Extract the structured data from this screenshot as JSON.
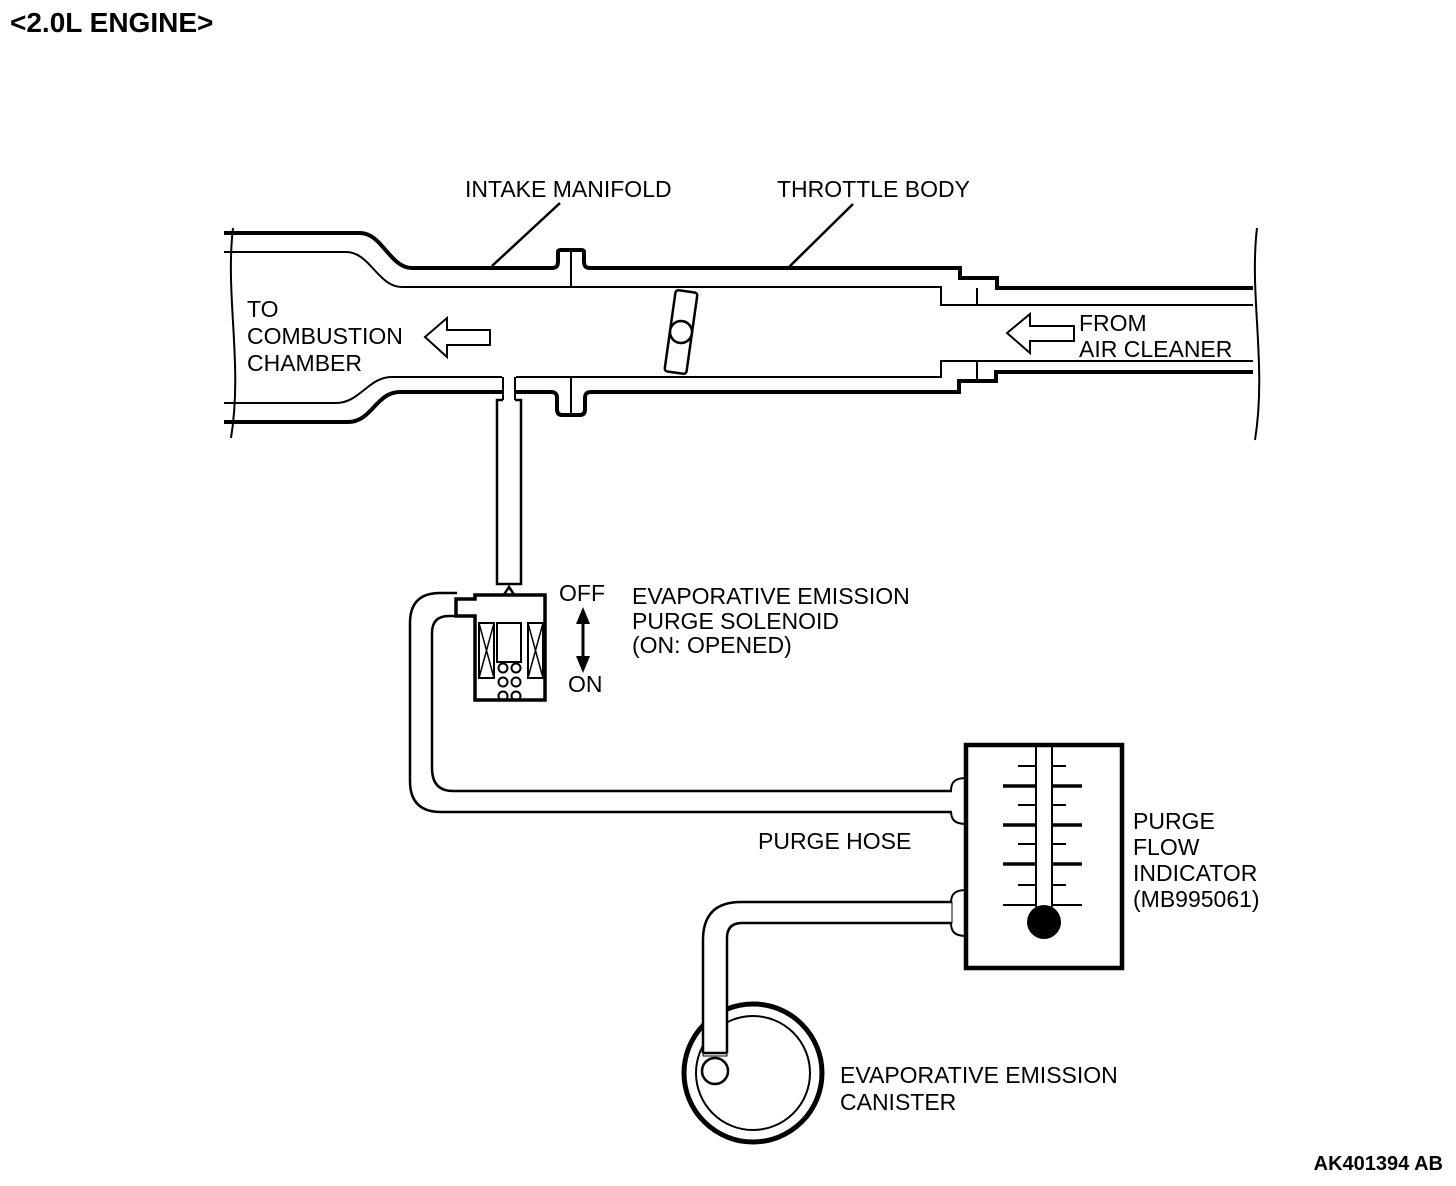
{
  "title": "<2.0L ENGINE>",
  "colors": {
    "line": "#000000",
    "background": "#ffffff"
  },
  "labels": {
    "intake_manifold": "INTAKE MANIFOLD",
    "throttle_body": "THROTTLE BODY",
    "to_combustion_chamber": [
      "TO",
      "COMBUSTION",
      "CHAMBER"
    ],
    "from_air_cleaner": [
      "FROM",
      "AIR CLEANER"
    ],
    "solenoid_state_off": "OFF",
    "solenoid_state_on": "ON",
    "purge_solenoid": [
      "EVAPORATIVE EMISSION",
      "PURGE SOLENOID",
      "(ON: OPENED)"
    ],
    "purge_hose": "PURGE HOSE",
    "purge_flow_indicator": [
      "PURGE",
      "FLOW",
      "INDICATOR",
      "(MB995061)"
    ],
    "evap_canister": [
      "EVAPORATIVE EMISSION",
      "CANISTER"
    ],
    "figure_code": "AK401394 AB"
  }
}
